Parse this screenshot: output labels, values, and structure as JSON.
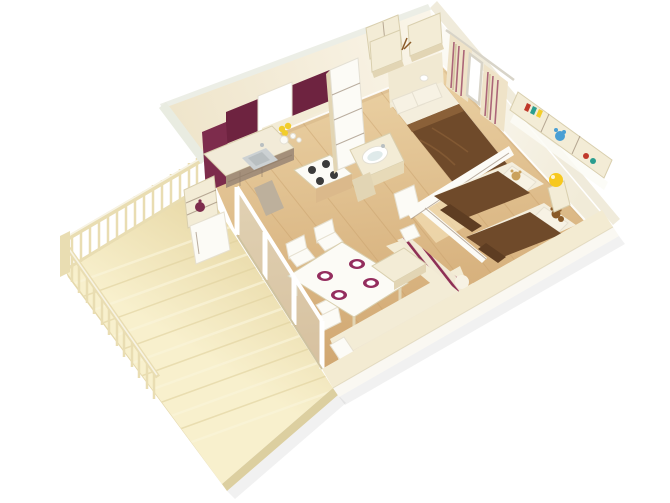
{
  "meta": {
    "description": "3D isometric rendering of a two-bedroom mobile-home floor plan with wooden terrace",
    "width_px": 670,
    "height_px": 503
  },
  "palette": {
    "bg": "#ffffff",
    "ext_band": "#f0ebdb",
    "ext_sliver": "#eceee6",
    "west_sliver": "#e9ece1",
    "front_band": "#f3ebd2",
    "front_band_face": "#faf8f2",
    "wall_bl_a": "#efe5cb",
    "wall_bl_b": "#faf5e9",
    "wall_br_a": "#fdfcf8",
    "wall_br_b": "#f1ebd8",
    "floor_a": "#ecd3a6",
    "floor_b": "#d0a670",
    "plank": "#c79f6b",
    "deck_a": "#e7d7a4",
    "deck_b": "#f8f0cd",
    "deck_streak": "#faf3d8",
    "deck_streak_dark": "#e0d09c",
    "deck_fascia": "#dccfa0",
    "deck_fascia_side": "#e6d9ab",
    "railing": "#e9ddb2",
    "railing_hi": "#f7f3e4",
    "burgundy": "#6e2340",
    "burgundy_light": "#7d2c4c",
    "counter": "#f2ebd8",
    "counter_face": "#e7dab8",
    "taupe": "#a48f7a",
    "taupe_light": "#bdb09c",
    "cream": "#f3ecd6",
    "cream_dark": "#e2d5b4",
    "white_furn": "#fcfbf6",
    "headboard": "#f1e9d2",
    "mattress": "#f4eedd",
    "pillow": "#f7f2e4",
    "duvet": "#6f4a2a",
    "duvet_light": "#8a6038",
    "duvet_dark": "#5e3d22",
    "stripe": "#8e2f55",
    "sofa_base": "#f1e9d4",
    "plate": "#942d5e",
    "steel": "#ccd1d3",
    "steel_dark": "#b9bfc1",
    "burner": "#3b3b3b",
    "glass": "#dfeaea",
    "track": "#cfc3a0",
    "lemon": "#f2cd2a",
    "lamp": "#f7c81e",
    "teddy": "#8a5a28",
    "teddy_tan": "#caa15c",
    "toy_blue": "#4a9fd4",
    "toy_red": "#c0392b",
    "toy_teal": "#2a9d8f",
    "curtain_base": "#efe3c8",
    "curtain_tan": "#c9b88e",
    "wood_base": "#dbb98b",
    "hall_light": "#f3dfb6",
    "mirror": "#ffffff"
  },
  "scene": {
    "view": "isometric-birdseye-cutaway",
    "structure": [
      "terrace-deck",
      "balustrade-railing",
      "exterior-walls",
      "interior-partitions",
      "sliding-glass-doors",
      "cutaway-front-wall"
    ],
    "rooms": [
      {
        "name": "kitchen",
        "items": [
          "burgundy-wall-cabinets",
          "open-cabinet-door",
          "window",
          "l-shaped-counter",
          "steel-sink",
          "four-burner-stove-island",
          "taupe-drawer-unit",
          "open-shelf-unit",
          "burgundy-teapot",
          "mini-fridge",
          "kettle-and-jars",
          "lemons"
        ]
      },
      {
        "name": "bathroom",
        "items": [
          "tall-storage-column",
          "overhead-cabinet",
          "vanity-cabinet",
          "oval-basin",
          "open-door"
        ]
      },
      {
        "name": "master-bedroom",
        "items": [
          "double-bed",
          "brown-duvet",
          "two-pillows",
          "headboard-panel",
          "overhead-cabinets",
          "dried-flower-decor",
          "wall-lamp",
          "striped-curtains",
          "mirror"
        ]
      },
      {
        "name": "kids-bedroom",
        "items": [
          "single-bed-1",
          "single-bed-2",
          "brown-duvets",
          "pillows",
          "tan-plush-toy",
          "teddy-bear",
          "nightstand-tower",
          "yellow-ball-lamp",
          "wall-shelf-cubbies",
          "toy-books",
          "blue-plush",
          "small-toys"
        ]
      },
      {
        "name": "living-dining",
        "items": [
          "dining-table",
          "four-maroon-place-settings",
          "three-white-chairs",
          "l-shaped-sofa",
          "striped-back-cushions",
          "white-armrest",
          "corner-pillow",
          "coffee-table-block"
        ]
      },
      {
        "name": "terrace",
        "items": [
          "wood-deck-planks",
          "corner-post",
          "back-railing",
          "side-railing"
        ]
      }
    ]
  }
}
